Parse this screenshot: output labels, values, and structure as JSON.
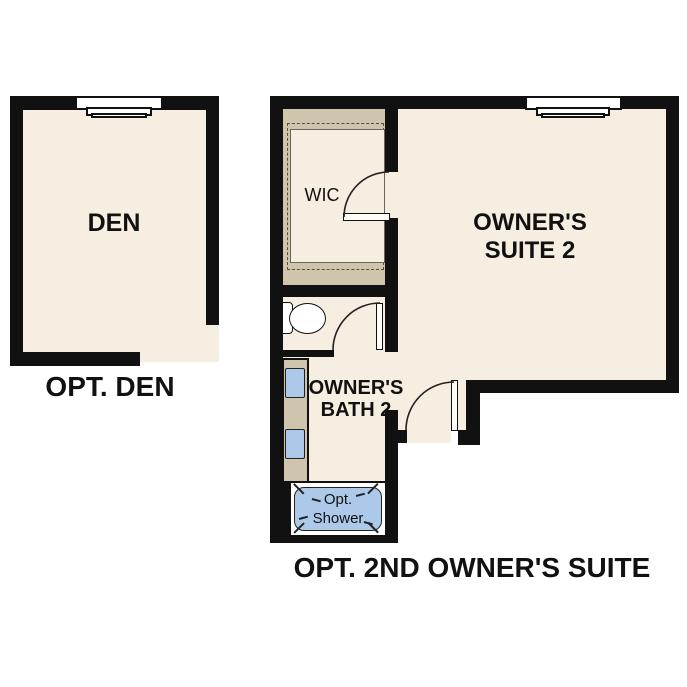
{
  "den_plan": {
    "room_label": "DEN",
    "caption": "OPT. DEN"
  },
  "suite_plan": {
    "caption": "OPT. 2ND OWNER'S SUITE",
    "owners_suite_label": "OWNER'S SUITE 2",
    "wic_label": "WIC",
    "bath_label": "OWNER'S BATH 2",
    "shower_label": "Opt. Shower"
  },
  "colors": {
    "wall": "#111111",
    "floor": "#f6eee0",
    "closet": "#cfc5ad",
    "fixture": "#adc9e9",
    "ink": "#111111",
    "bg": "#ffffff"
  }
}
